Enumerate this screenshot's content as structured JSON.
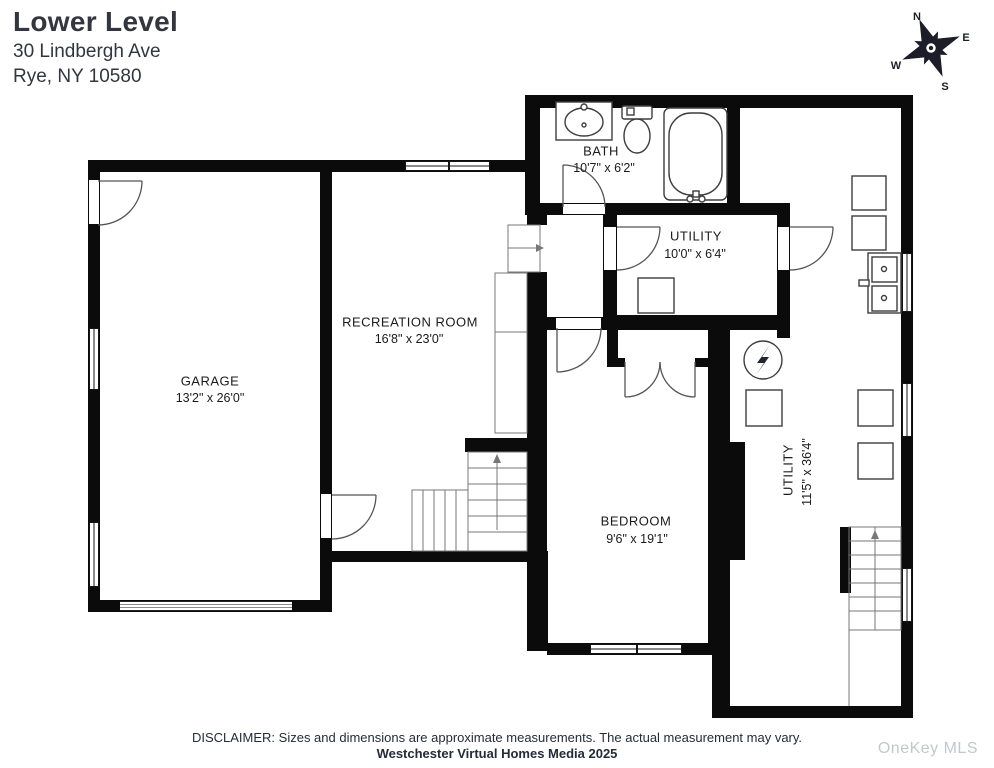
{
  "header": {
    "title": "Lower Level",
    "address_line1": "30 Lindbergh Ave",
    "address_line2": "Rye, NY 10580"
  },
  "compass": {
    "n": "N",
    "e": "E",
    "s": "S",
    "w": "W"
  },
  "rooms": {
    "garage": {
      "name": "GARAGE",
      "dims": "13'2\" x 26'0\""
    },
    "recreation": {
      "name": "RECREATION ROOM",
      "dims": "16'8\" x 23'0\""
    },
    "bath": {
      "name": "BATH",
      "dims": "10'7\" x 6'2\""
    },
    "utility_small": {
      "name": "UTILITY",
      "dims": "10'0\" x 6'4\""
    },
    "bedroom": {
      "name": "BEDROOM",
      "dims": "9'6\" x 19'1\""
    },
    "utility_large": {
      "name": "UTILITY",
      "dims": "11'5\" x 36'4\""
    }
  },
  "footer": {
    "disclaimer": "DISCLAIMER: Sizes and dimensions are approximate measurements. The actual measurement may vary.",
    "credit": "Westchester Virtual Homes Media 2025",
    "watermark": "OneKey MLS"
  }
}
